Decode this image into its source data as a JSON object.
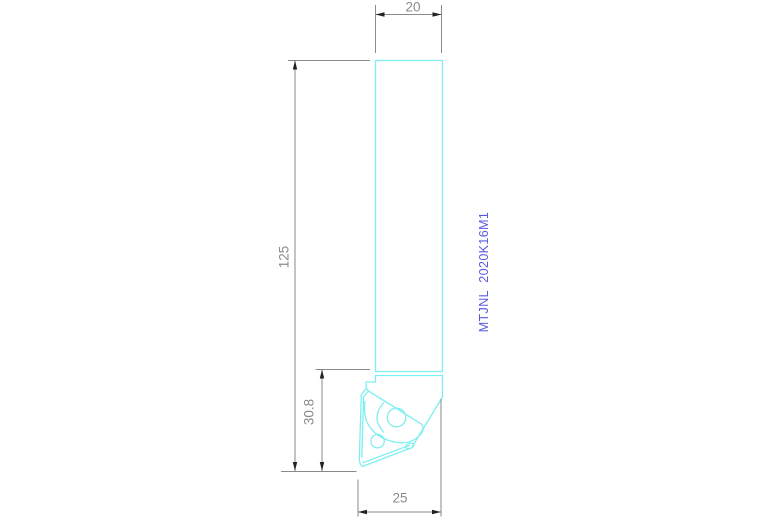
{
  "drawing": {
    "part_label": "MTJNL  2020K16M1",
    "dim_top_width": "20",
    "dim_overall_length": "125",
    "dim_head_length": "30.8",
    "dim_bottom_width": "25",
    "colors": {
      "background": "#ffffff",
      "outline": "#7deff0",
      "dimension": "#8a8a8a",
      "arrow": "#222222",
      "label": "#5a5ae0"
    }
  }
}
